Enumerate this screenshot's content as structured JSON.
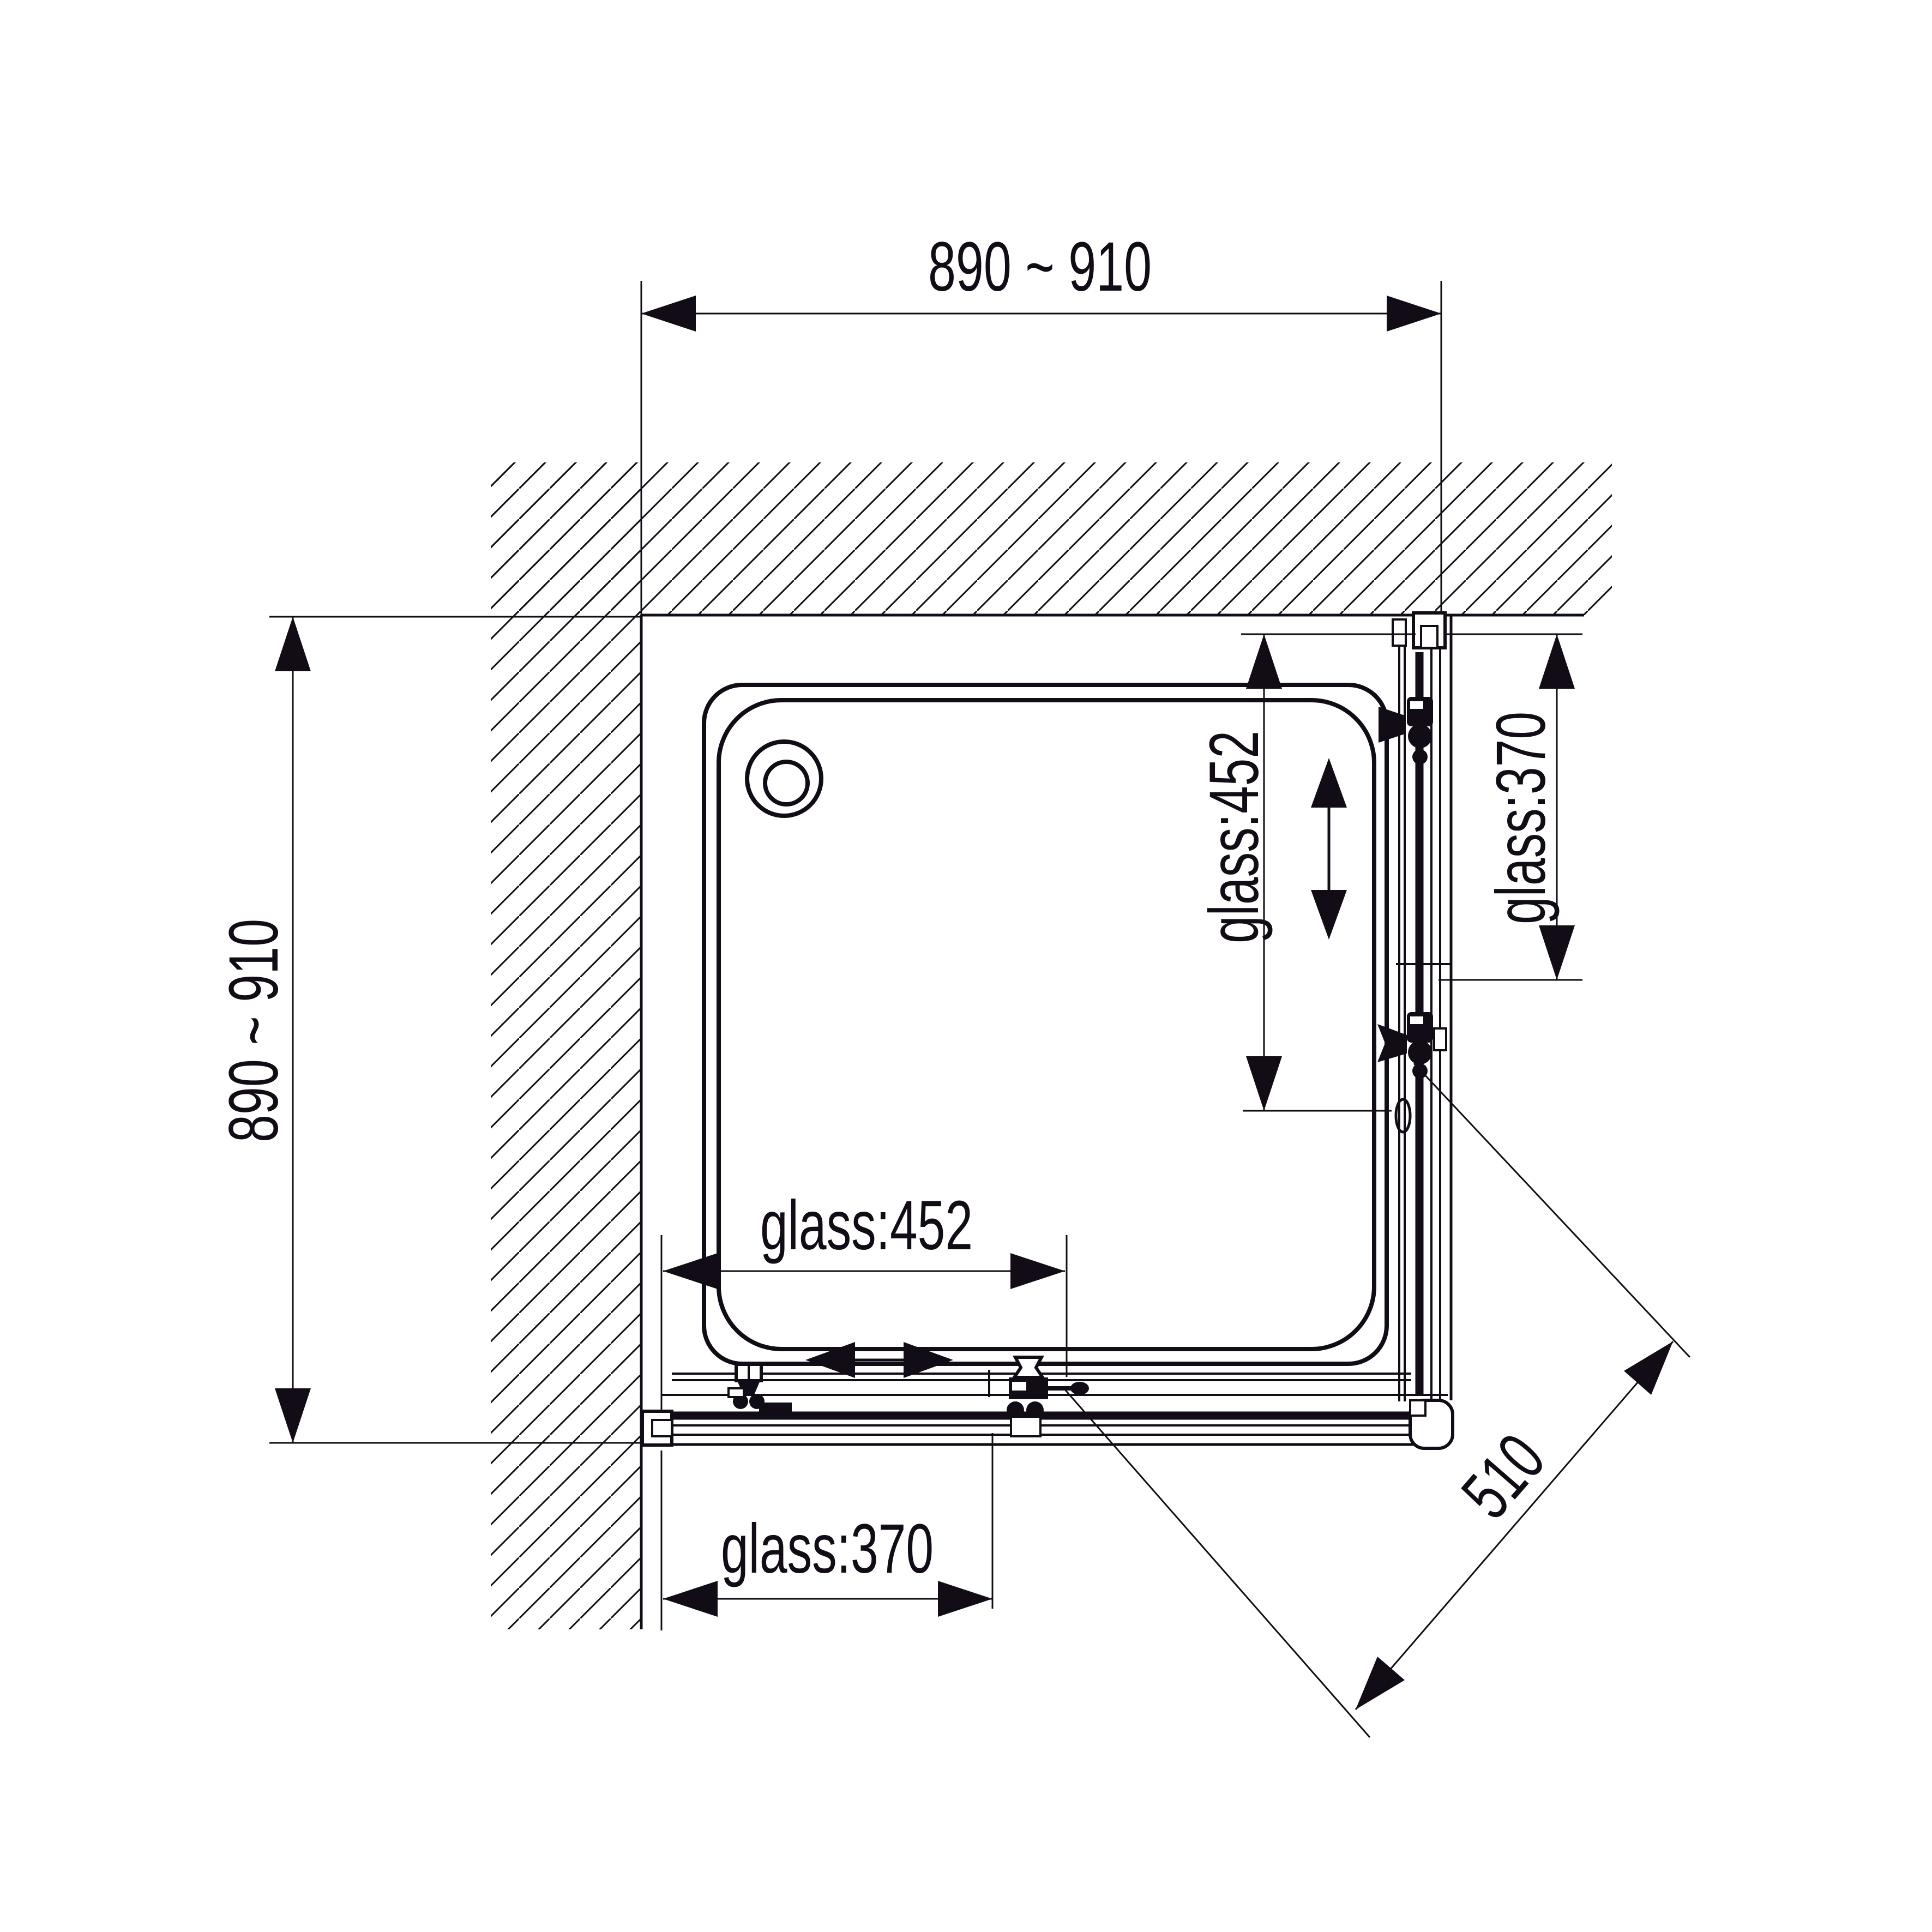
{
  "drawing": {
    "type": "shower-enclosure-plan-view",
    "units": "mm",
    "background_color": "#ffffff",
    "line_color": "#120c16",
    "labels": {
      "top_width": "890 ~ 910",
      "left_depth": "890 ~ 910",
      "right_glass_452": "glass:452",
      "right_glass_370": "glass:370",
      "bottom_glass_452": "glass:452",
      "bottom_glass_370": "glass:370",
      "diagonal_510": "510"
    },
    "values": {
      "enclosure_width_range_mm": "890 ~ 910",
      "enclosure_depth_range_mm": "890 ~ 910",
      "sliding_glass_panel_mm": 452,
      "fixed_glass_panel_mm": 370,
      "diagonal_corner_opening_mm": 510
    }
  }
}
